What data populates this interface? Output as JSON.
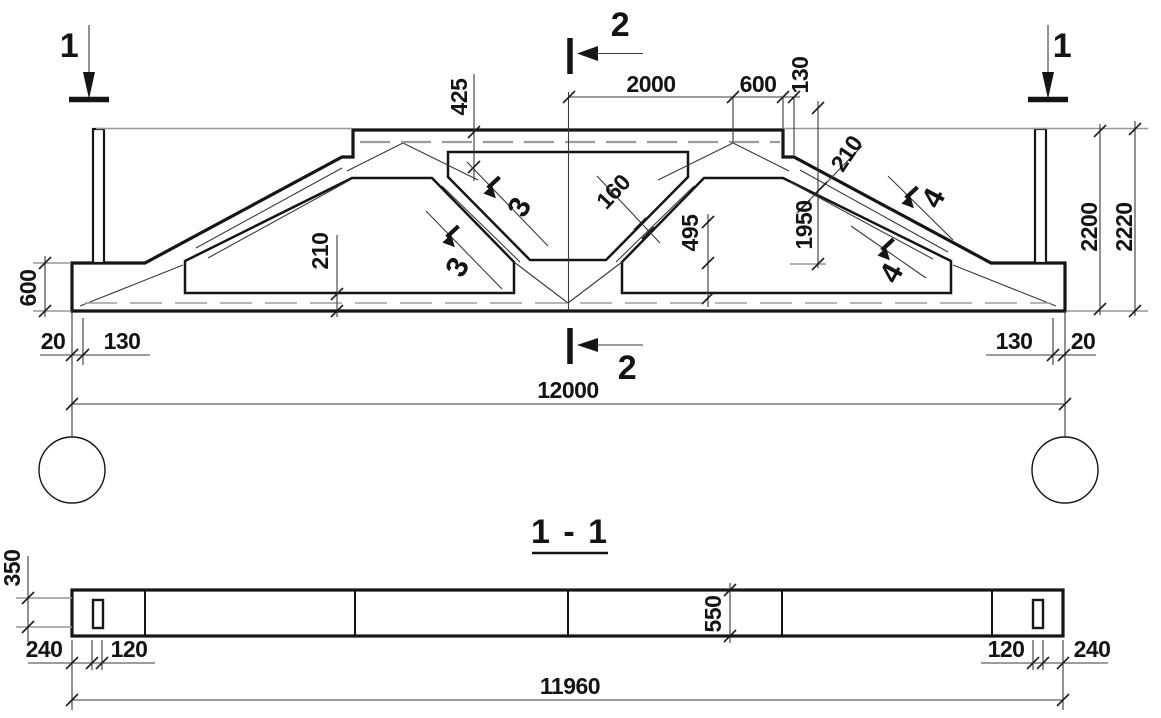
{
  "drawing": {
    "type": "structural-truss-working-drawing",
    "elevation": {
      "markers": {
        "one_left": "1",
        "one_right": "1",
        "two_top": "2",
        "two_bottom": "2"
      },
      "cuts": {
        "three_upper": "3",
        "three_lower": "3",
        "four_upper": "4",
        "four_lower": "4"
      },
      "dims": {
        "top_2000": "2000",
        "top_600": "600",
        "top_130": "130",
        "h425": "425",
        "t160": "160",
        "v495": "495",
        "h1950": "1950",
        "t210_right": "210",
        "h2200": "2200",
        "h2220": "2220",
        "v600_left": "600",
        "t210_bottom": "210",
        "e20_left": "20",
        "e130_left": "130",
        "e130_right": "130",
        "e20_right": "20",
        "span_12000": "12000"
      }
    },
    "section": {
      "title": "1 - 1",
      "dims": {
        "v350": "350",
        "v550": "550",
        "e240_left": "240",
        "e120_left": "120",
        "e120_right": "120",
        "e240_right": "240",
        "length_11960": "11960"
      }
    },
    "colors": {
      "ink": "#151515",
      "gray": "#979797",
      "background": "#ffffff"
    }
  }
}
